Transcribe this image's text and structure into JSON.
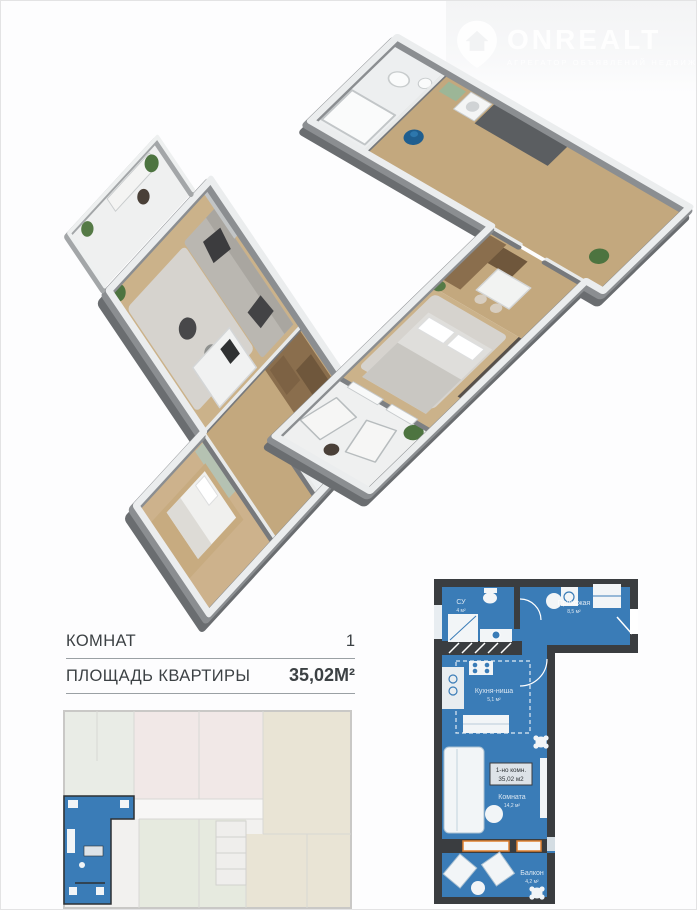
{
  "logo": {
    "brand": "ONREALT",
    "tagline": "АГРЕГАТОР ОБЪЯВЛЕНИЙ НЕДВИЖИМОСТИ",
    "icon": "house-pin-icon"
  },
  "summary": {
    "rooms_label": "КОМНАТ",
    "rooms_value": "1",
    "area_label": "ПЛОЩАДЬ КВАРТИРЫ",
    "area_value": "35,02М²"
  },
  "plan2d": {
    "unit_type": "1-но комн.",
    "unit_area": "35,02 м2",
    "rooms": {
      "su": {
        "name": "СУ",
        "area": "4 м²"
      },
      "hall": {
        "name": "Прихожая",
        "area": "8,5 м²"
      },
      "kitchen": {
        "name": "Кухня-ниша",
        "area": "5,1 м²"
      },
      "room": {
        "name": "Комната",
        "area": "14,2 м²"
      },
      "balcony": {
        "name": "Балкон",
        "area": "4,2 м²"
      }
    },
    "colors": {
      "apartment_fill": "#3a7cb7",
      "walls": "#3a3d40",
      "window_frame": "#e0802f",
      "fixtures": "#f2f5f7"
    }
  },
  "renders3d": {
    "wall_color": "#8a8d90",
    "wall_top_color": "#ebedee",
    "wood_floor": "#cbb28a",
    "corridor_wood": "#c3a87e",
    "tile_floor": "#edeff0",
    "rug": "#d6d3ce",
    "sofa": "#bab7b1",
    "plant": "#4d7440",
    "pouf_blue": "#1f5e8f",
    "cabinet_wood": "#8a6e4d"
  },
  "building_plan": {
    "highlight_fill": "#3a7cb7",
    "base_fill": "#f2f1ef",
    "tint_pink": "#f1e8e7",
    "tint_green": "#e6eadf",
    "tint_khaki": "#e9e4d5"
  }
}
